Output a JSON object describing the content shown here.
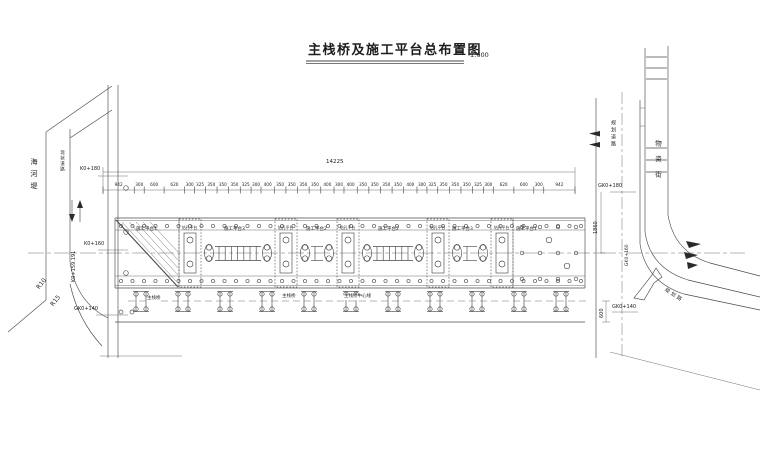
{
  "title": {
    "text": "主栈桥及施工平台总布置图",
    "scale": "1:600"
  },
  "dims": {
    "total": "14225",
    "chain": [
      942,
      300,
      600,
      620,
      300,
      325,
      350,
      350,
      350,
      325,
      300,
      400,
      350,
      350,
      350,
      350,
      400,
      300,
      400,
      350,
      350,
      350,
      350,
      400,
      300,
      325,
      350,
      350,
      350,
      325,
      300,
      620,
      600,
      300,
      942
    ],
    "bridge_width": "1860",
    "trestle_offset": "600"
  },
  "stations": {
    "k0_180": "K0+180",
    "k0_160": "K0+160",
    "gk0_140_left": "GK0+140",
    "chainage": "K0+159.191",
    "gk0_180": "GK0+180",
    "gk0_160": "GK0+160",
    "gk0_140_right": "GK0+140"
  },
  "platforms": {
    "p1": "施工平台1",
    "p2": "施工平台2",
    "p3": "施工平台3",
    "drill": "钻孔平台"
  },
  "trestle": {
    "label": "主栈桥",
    "centerline": "主栈桥中心线"
  },
  "roads": {
    "left_embankment": "海河堤",
    "left_existing": "现状道路",
    "right_planned": "规划道路",
    "right_street": "物资街",
    "bottom_street": "规划路"
  },
  "curves": {
    "r10": "R10",
    "r15": "R15"
  }
}
